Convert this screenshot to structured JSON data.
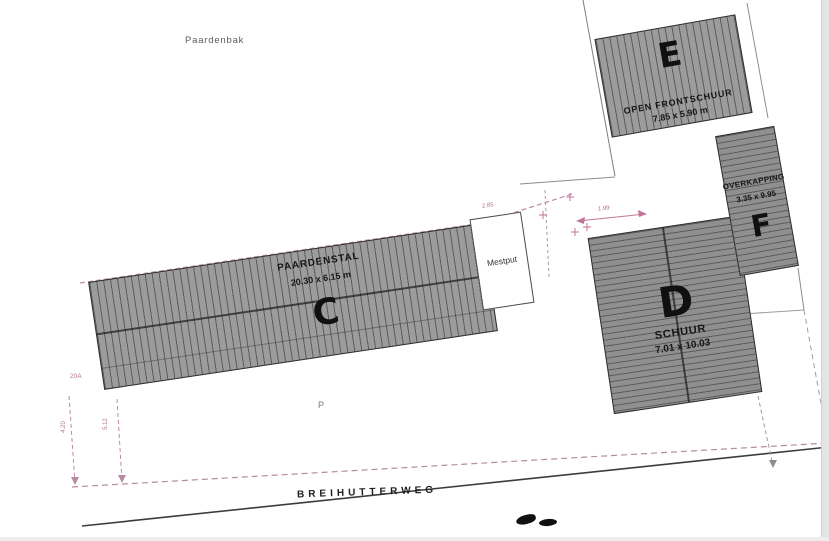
{
  "plan": {
    "area_labels": {
      "paardenbak": "Paardenbak",
      "parking": "P",
      "street": "BREIHUTTERWEG",
      "mestput": "Mestput"
    },
    "buildings": [
      {
        "id": "C",
        "name": "PAARDENSTAL",
        "dimensions": "20.30 x 6.15 m"
      },
      {
        "id": "D",
        "name": "SCHUUR",
        "dimensions": "7.01 x 10.03"
      },
      {
        "id": "E",
        "name": "OPEN FRONTSCHUUR",
        "dimensions": "7.85 x 5.90 m"
      },
      {
        "id": "F",
        "name": "OVERKAPPING",
        "dimensions": "3.35 x 9.95"
      }
    ],
    "annotations": {
      "dim_285": "2.85",
      "dim_199": "1.99",
      "dim_420": "4.20",
      "dim_512": "5.12",
      "mark_20a": "20A"
    },
    "colors": {
      "roof_fill_light": "#9c9c9c",
      "roof_fill_dark": "#8f8f8f",
      "outline": "#2e2e2e",
      "boundary_pink": "#bd8aa4",
      "road_line": "#3d3d3d"
    }
  }
}
